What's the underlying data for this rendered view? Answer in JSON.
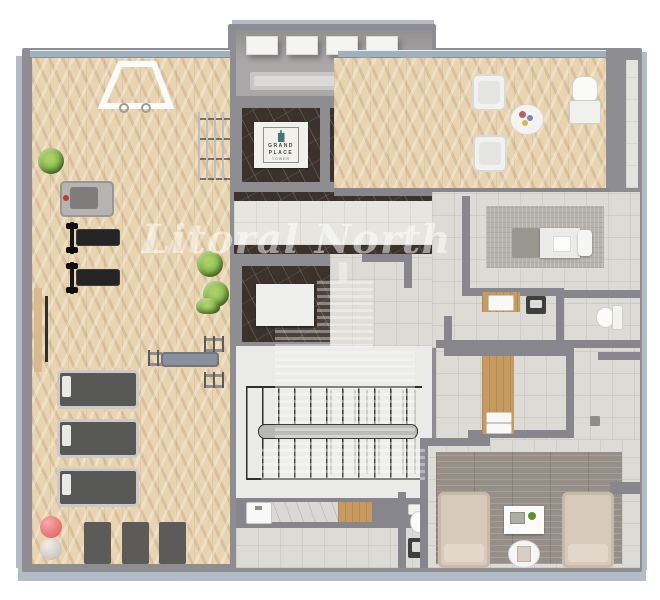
{
  "watermark": {
    "text": "Litoral North"
  },
  "elevator_logo": {
    "line1": "GRAND",
    "line2": "PLACE",
    "subtitle": "TOWER"
  },
  "palette": {
    "page_background": "#ffffff",
    "slab_edge_blue": "#b2bcc6",
    "wall_gray": "#8e8d91",
    "gym_wood_floor": "#e8d4b0",
    "tile_floor": "#dcdbd6",
    "elevator_dark_marble": "#3a322b",
    "stair_room_floor": "#eaeae8",
    "lounge_plank_rug": "#968f88",
    "massage_rug": "#b6b3ac",
    "armchair_beige": "#d8cabb",
    "equipment_black": "#242424",
    "treadmill_belt": "#585856",
    "plant_green": "#7cae45",
    "ball_pink": "#e76e72",
    "logo_teal": "#41776f",
    "counter_wood": "#c79a5f",
    "window_band_blue": "#9db1c0",
    "watermark_white": "rgba(255,255,255,0.5)"
  }
}
